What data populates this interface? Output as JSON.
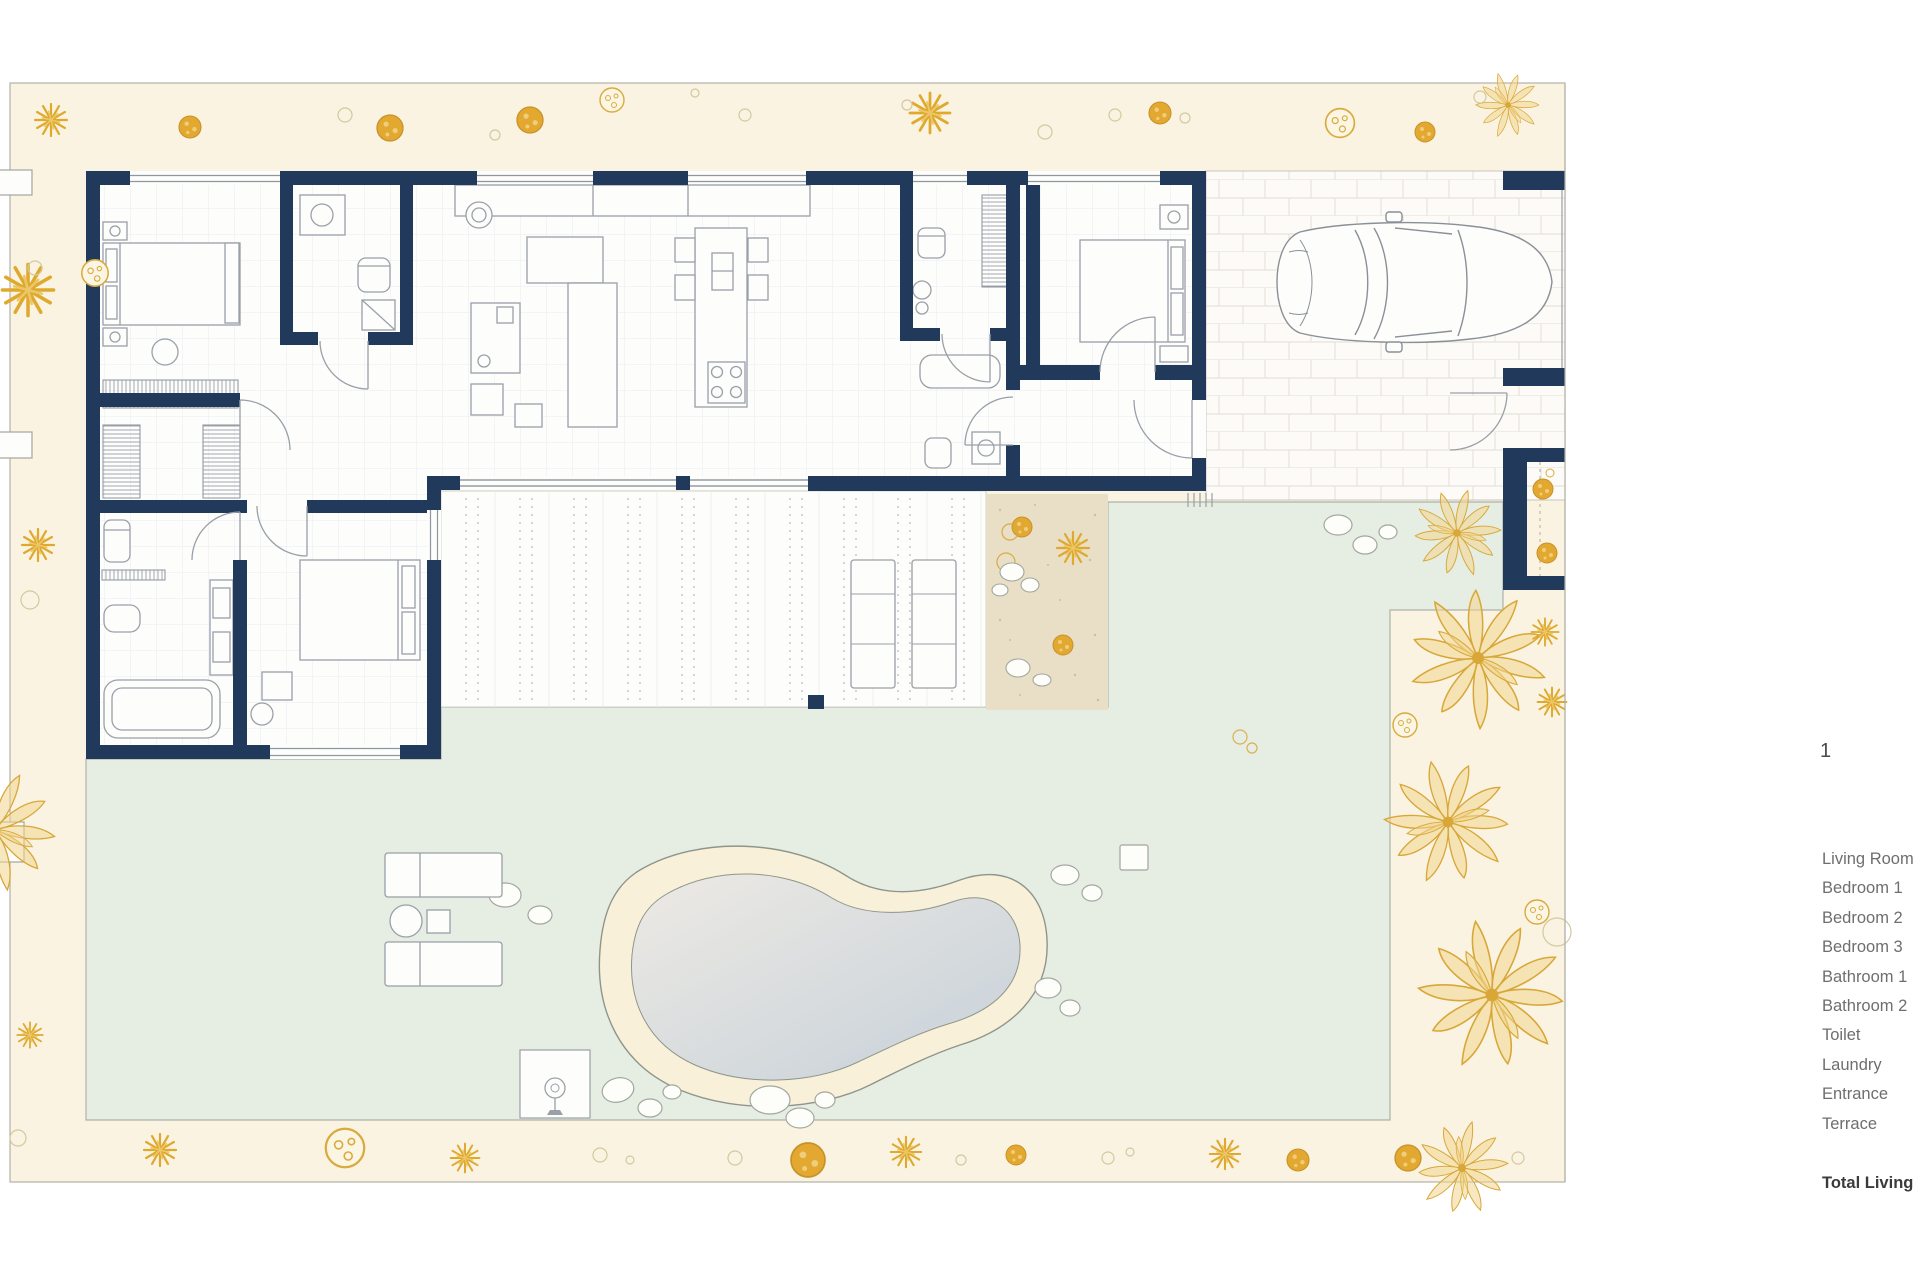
{
  "legend": {
    "items": [
      "Living Room",
      "Bedroom 1",
      "Bedroom  2",
      "Bedroom  3",
      "Bathroom 1",
      "Bathroom 2",
      "Toilet",
      "Laundry",
      "Entrance",
      "Terrace"
    ],
    "total_label": "Total Living"
  },
  "annotation": {
    "mark": "1"
  },
  "colors": {
    "wall_navy": "#21395a",
    "plant_gold": "#dfa92e",
    "site_cream": "#faf3e2",
    "lawn_green": "#e6ede3",
    "sand_tan": "#e8dfc6",
    "pool_water": "#c6d0d9",
    "pool_deck": "#f8f0d8",
    "furniture_gray": "#9aa0a8"
  }
}
